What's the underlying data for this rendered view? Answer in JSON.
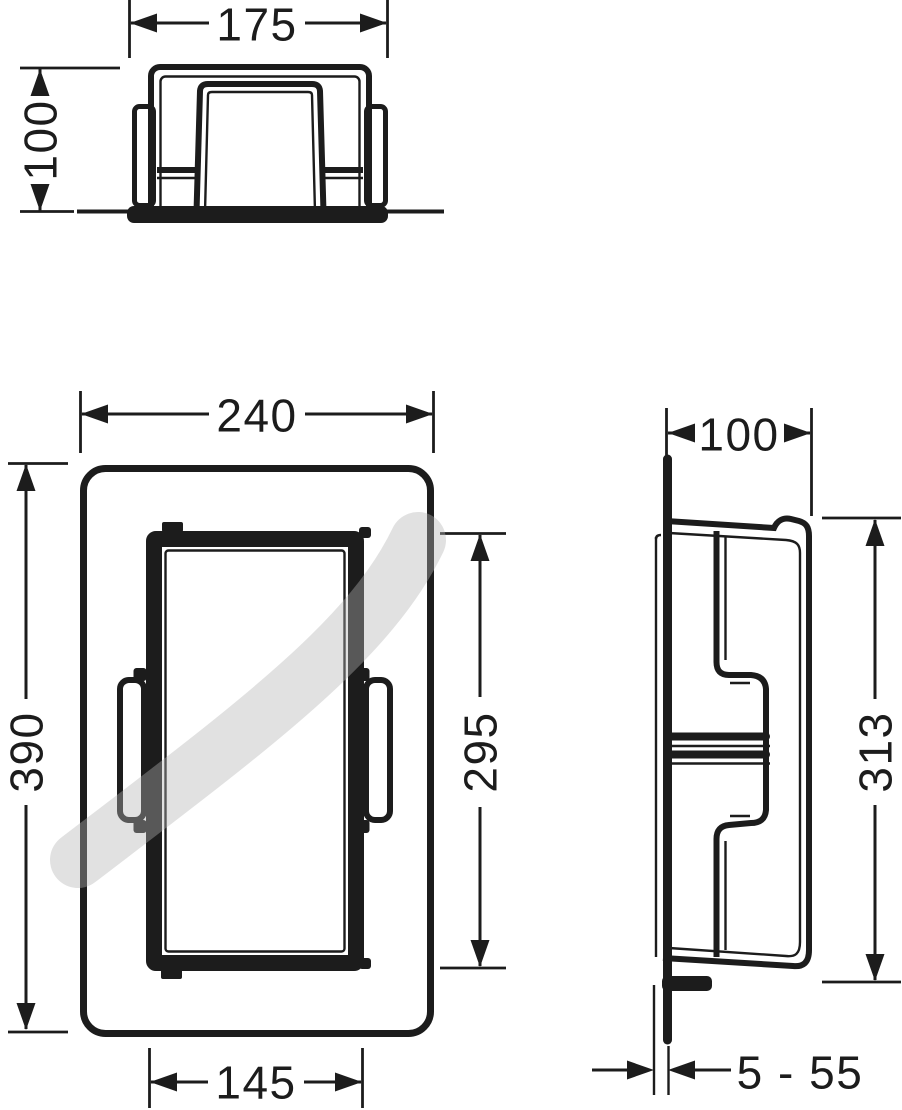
{
  "drawing": {
    "type": "technical-dimension-drawing",
    "subject": "wall niche installation drawing, three orthographic views",
    "colors": {
      "line": "#1c1c1c",
      "background": "#ffffff",
      "watermark": "rgba(180,180,180,0.40)"
    },
    "views": {
      "top": {
        "label": "top-section-view",
        "overall_width": "175",
        "overall_depth": "100"
      },
      "front": {
        "label": "front-elevation-view",
        "overall_width": "240",
        "overall_height": "390",
        "opening_height": "295",
        "opening_width": "145"
      },
      "side": {
        "label": "side-section-view",
        "overall_depth": "100",
        "body_height": "313",
        "flange_offset_range": "5 - 55"
      }
    }
  }
}
